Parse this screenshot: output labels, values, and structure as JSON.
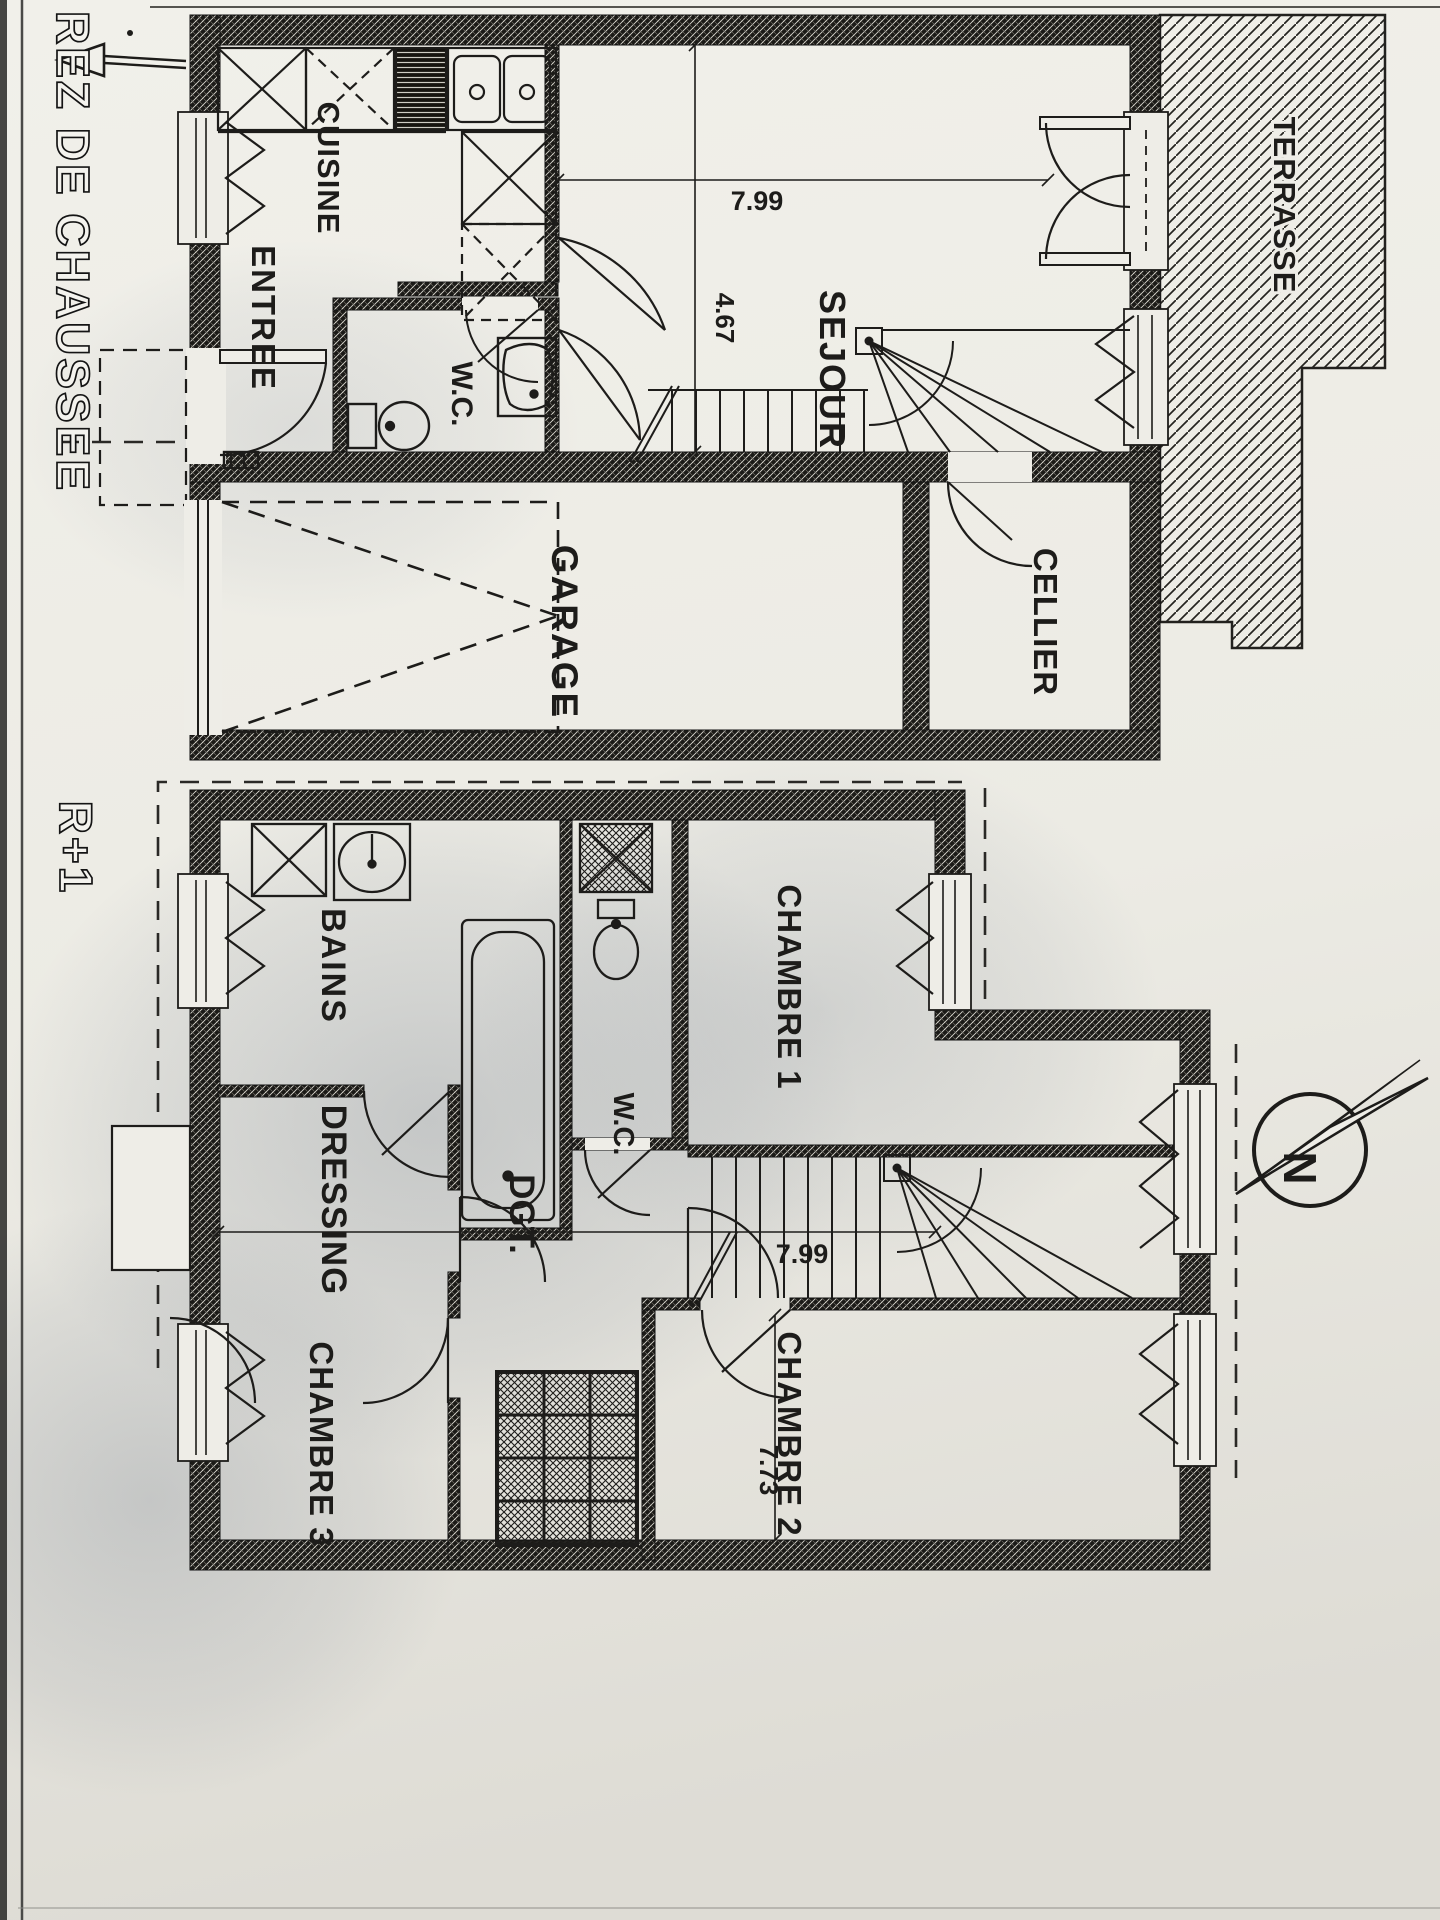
{
  "colors": {
    "paper": "#eeede7",
    "paper_dark": "#e0ded7",
    "ink": "#1d1c1a",
    "shadow": "#6e7888"
  },
  "floors": {
    "ground": {
      "title": "REZ DE CHAUSSEE",
      "rooms": {
        "cuisine": "CUISINE",
        "entree": "ENTREE",
        "wc": "W.C.",
        "sejour": "SEJOUR",
        "garage": "GARAGE",
        "cellier": "CELLIER",
        "terrasse": "TERRASSE"
      },
      "dimensions": {
        "sejour_width": "7.99",
        "sejour_depth": "4.67"
      }
    },
    "first": {
      "title": "R+1",
      "rooms": {
        "bains": "BAINS",
        "wc": "W.C.",
        "chambre1": "CHAMBRE 1",
        "dressing": "DRESSING",
        "degagement": "DGT.",
        "chambre2": "CHAMBRE 2",
        "chambre3": "CHAMBRE 3"
      },
      "dimensions": {
        "width": "7.99",
        "depth": "7.73"
      }
    }
  },
  "compass": {
    "north_label": "N"
  }
}
